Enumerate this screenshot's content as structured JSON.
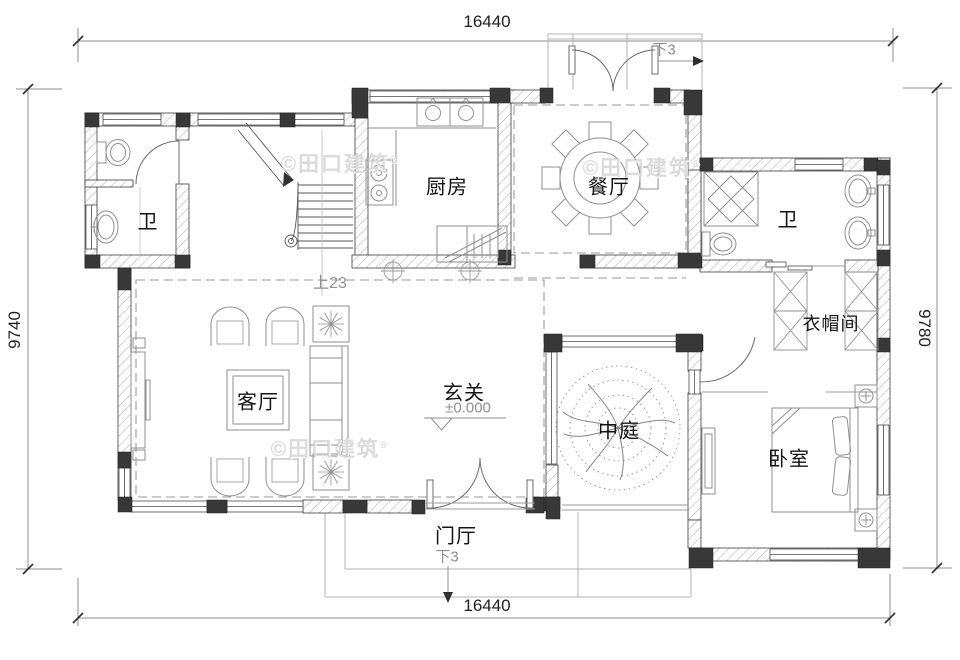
{
  "plan": {
    "dimensions": {
      "top": "16440",
      "bottom": "16440",
      "left": "9740",
      "right": "9780"
    },
    "rooms": {
      "bath_left": "卫",
      "kitchen": "厨房",
      "dining": "餐厅",
      "bath_right": "卫",
      "cloakroom": "衣帽间",
      "living": "客厅",
      "entry_hall": "玄关",
      "atrium": "中庭",
      "bedroom": "卧室",
      "porch": "门厅"
    },
    "annotations": {
      "level": "±0.000",
      "stairs_up": "上23",
      "door_down_top": "下3",
      "door_down_bottom": "下3"
    },
    "watermark": {
      "text": "©田口建筑",
      "reg": "®"
    }
  },
  "colors": {
    "wall_line": "#3c3c3c",
    "column_fill": "#383838",
    "furniture_line": "#8f8f8f",
    "dash_line": "#9a9a9a",
    "annotation_text": "#8f8f8f",
    "dimension_text": "#1f1f1f",
    "watermark_text": "#d9d9d9"
  }
}
